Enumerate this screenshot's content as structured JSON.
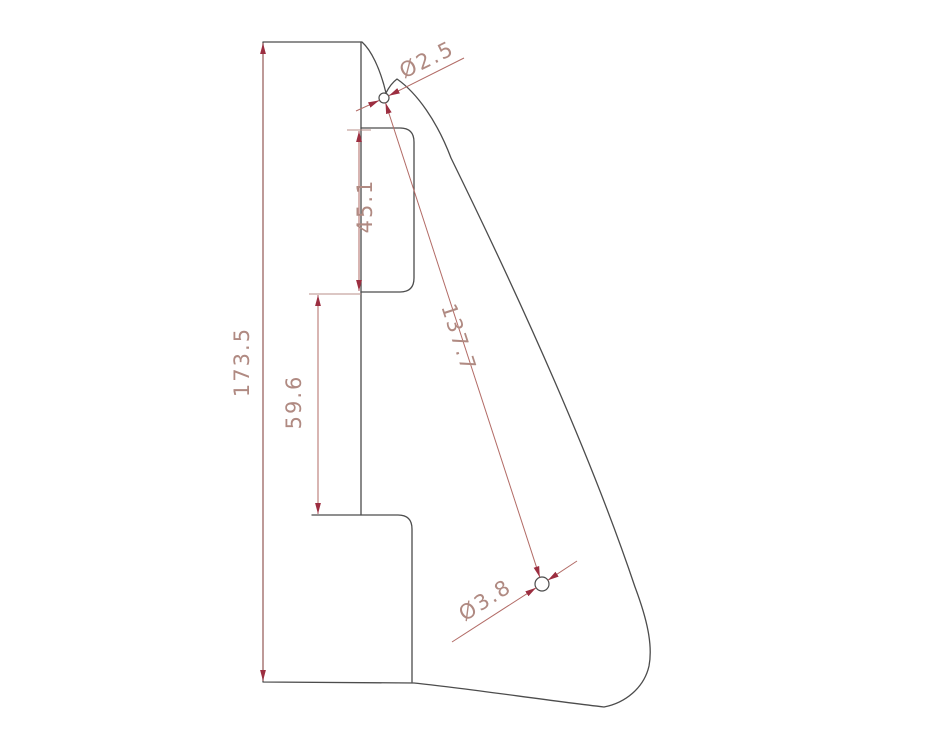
{
  "drawing": {
    "type": "technical-cad-drawing",
    "subject": "pickguard-profile-with-pickup-cutout",
    "background_color": "#ffffff",
    "outline_color": "#4c4c4c",
    "dimension_line_color": "#b26b66",
    "dimension_text_color": "#b08a82",
    "arrow_color": "#9c2e40"
  },
  "dims": {
    "overall_height": "173.5",
    "cutout_height": "45.1",
    "step_offset": "59.6",
    "hole_spacing": "137.7",
    "small_hole_dia": "Ø2.5",
    "large_hole_dia": "Ø3.8"
  }
}
